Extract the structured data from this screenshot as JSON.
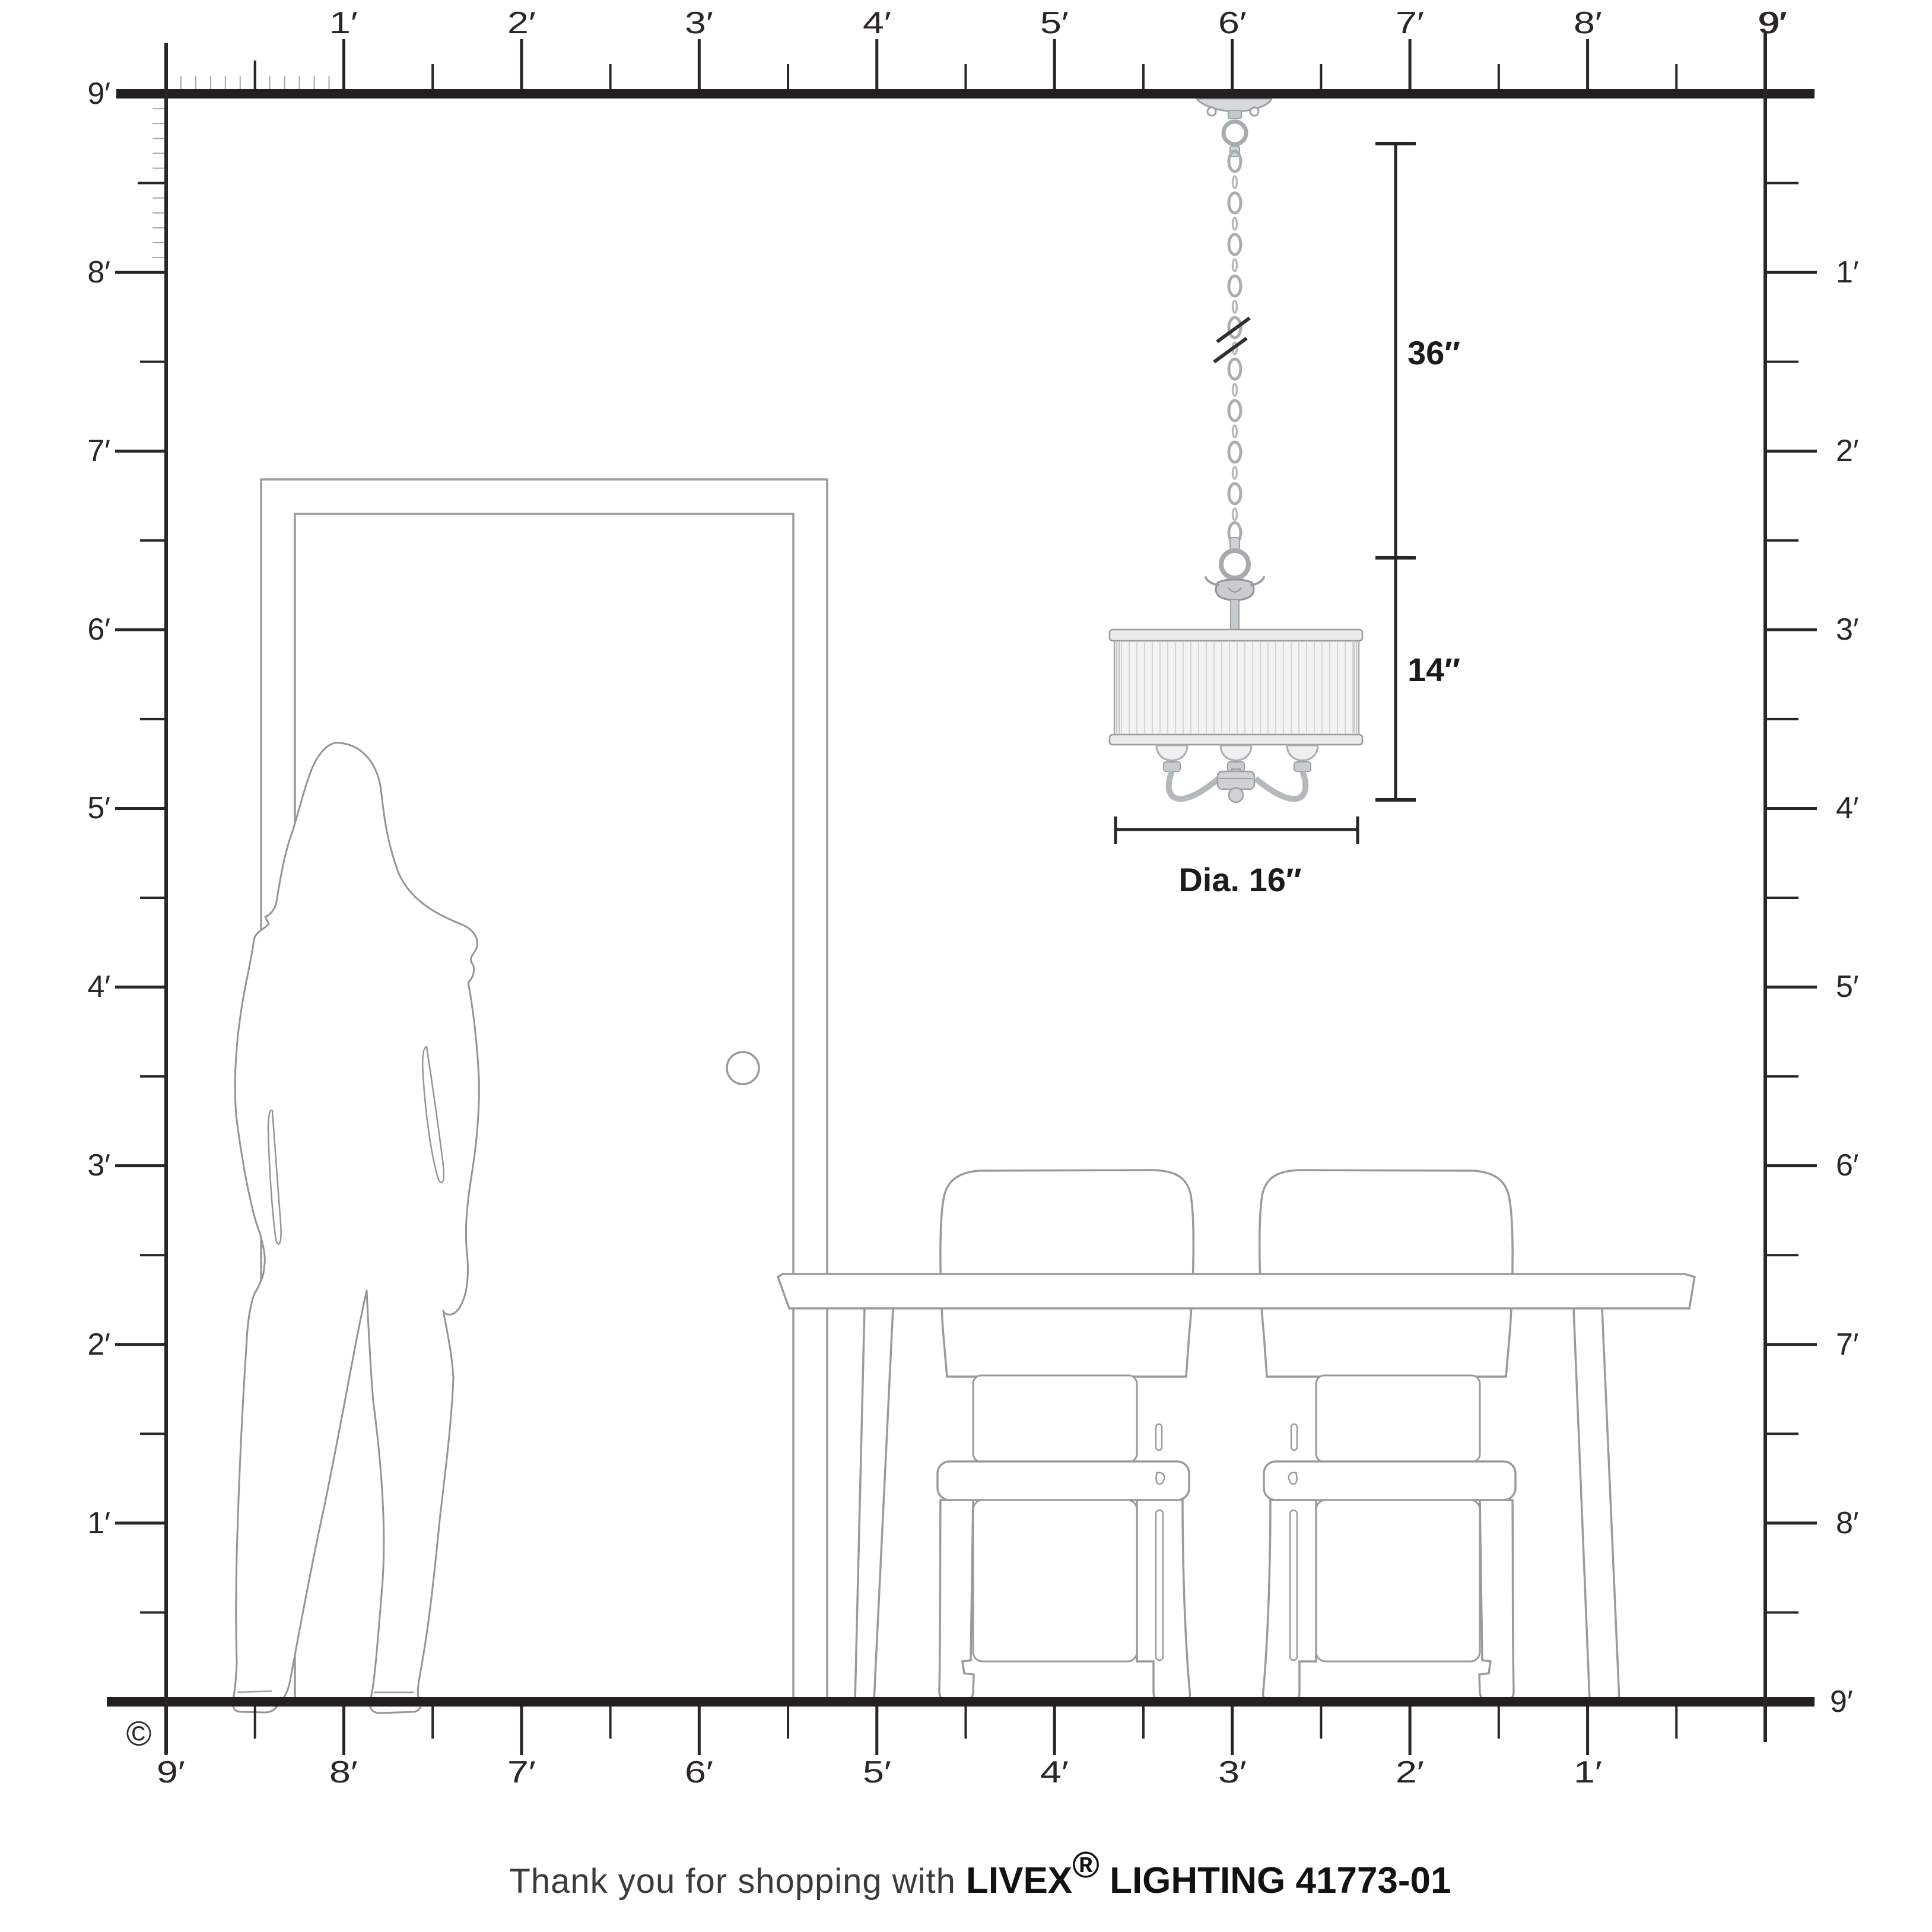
{
  "title": "Room scale diagram for pendant light",
  "rulers": {
    "top": [
      "1′",
      "2′",
      "3′",
      "4′",
      "5′",
      "6′",
      "7′",
      "8′",
      "9′"
    ],
    "left": [
      "9′",
      "8′",
      "7′",
      "6′",
      "5′",
      "4′",
      "3′",
      "2′",
      "1′"
    ],
    "right": [
      "9′",
      "1′",
      "2′",
      "3′",
      "4′",
      "5′",
      "6′",
      "7′",
      "8′",
      "9′"
    ],
    "bottom": [
      "9′",
      "8′",
      "7′",
      "6′",
      "5′",
      "4′",
      "3′",
      "2′",
      "1′"
    ]
  },
  "dimensions": {
    "chain_drop": "36″",
    "fixture_height": "14″",
    "diameter": "Dia. 16″"
  },
  "footer": {
    "prefix": "Thank you for shopping with ",
    "brand": "LIVEX",
    "registered": "®",
    "suffix": " LIGHTING 41773-01"
  },
  "copyright": "©",
  "colors": {
    "ruler": "#2a2627",
    "bar": "#231f20",
    "outline_gray": "#969696",
    "metal_gray": "#a9aeb1",
    "shade_fill": "#f3f3f3"
  }
}
